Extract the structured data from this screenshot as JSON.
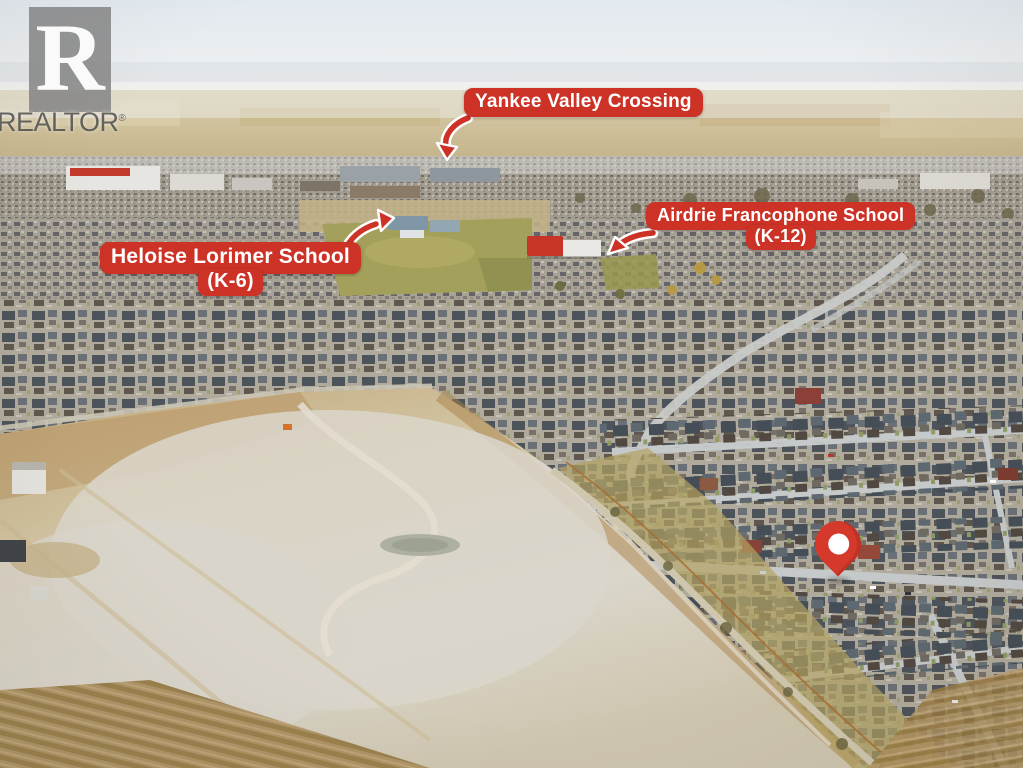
{
  "watermark": {
    "brand": "REALTOR",
    "registered_mark": "®",
    "logo_letter": "R"
  },
  "annotations": {
    "yankee": {
      "line1": "Yankee Valley Crossing"
    },
    "airdrie": {
      "line1": "Airdrie Francophone School",
      "line2": "(K-12)"
    },
    "heloise": {
      "line1": "Heloise Lorimer School",
      "line2": "(K-6)"
    }
  },
  "colors": {
    "label_red": "#cd3227",
    "label_text": "#ffffff",
    "arrow_red": "#cd3227",
    "arrow_outline": "#ffffff",
    "pin_red": "#d5392b",
    "pin_inner_white": "#ffffff"
  }
}
